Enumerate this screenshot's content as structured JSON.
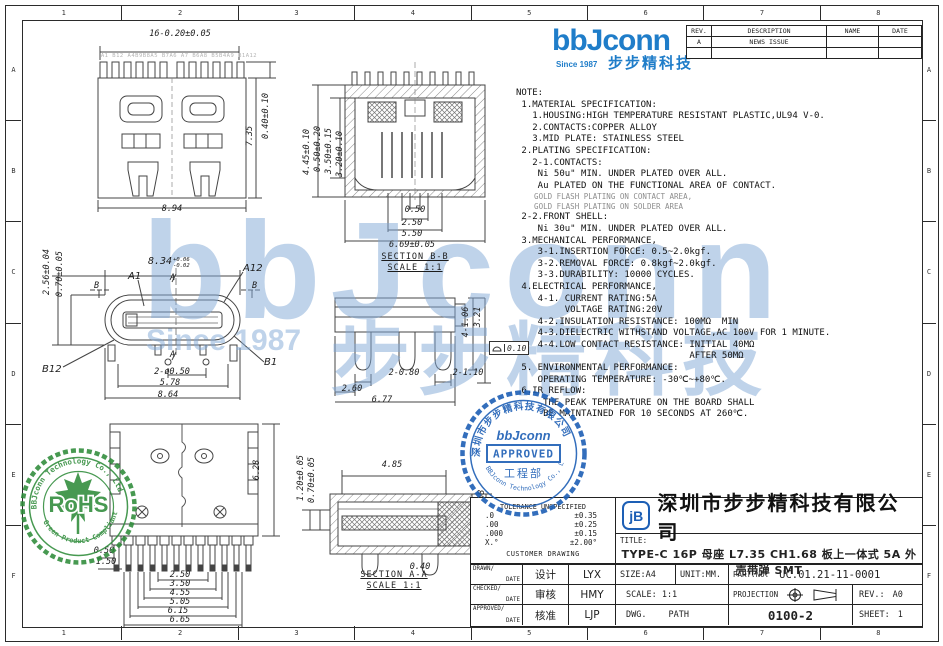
{
  "grid": {
    "cols": [
      "1",
      "2",
      "3",
      "4",
      "5",
      "6",
      "7",
      "8"
    ],
    "rows": [
      "A",
      "B",
      "C",
      "D",
      "E",
      "F"
    ]
  },
  "header": {
    "brand": "bbJconn",
    "since": "Since 1987",
    "brand_cn": "步步精科技"
  },
  "rev_table": {
    "h_rev": "REV.",
    "h_desc": "DESCRIPTION",
    "h_name": "NAME",
    "h_date": "DATE",
    "r1_rev": "A",
    "r1_desc": "NEWS ISSUE"
  },
  "note": {
    "part1": "NOTE:\n 1.MATERIAL SPECIFICATION:\n   1.HOUSING:HIGH TEMPERATURE RESISTANT PLASTIC,UL94 V-0.\n   2.CONTACTS:COPPER ALLOY\n   3.MID PLATE: STAINLESS STEEL\n 2.PLATING SPECIFICATION:\n   2-1.CONTACTS:\n    Ni 50u\" MIN. UNDER PLATED OVER ALL.\n    Au PLATED ON THE FUNCTIONAL AREA OF CONTACT.",
    "gold1": "    GOLD FLASH PLATING ON CONTACT AREA,",
    "gold2": "    GOLD FLASH PLATING ON SOLDER AREA",
    "part2": " 2-2.FRONT SHELL:\n    Ni 30u\" MIN. UNDER PLATED OVER ALL.\n 3.MECHANICAL PERFORMANCE,\n    3-1.INSERTION FORCE: 0.5~2.0kgf.\n    3-2.REMOVAL FORCE: 0.8kgf~2.0kgf.\n    3-3.DURABILITY: 10000 CYCLES.\n 4.ELECTRICAL PERFORMANCE,\n    4-1. CURRENT RATING:5A\n         VOLTAGE RATING:20V\n    4-2.INSULATION RESISTANCE: 100MΩ  MIN\n    4-3.DIELECTRIC WITHSTAND VOLTAGE,AC 100V FOR 1 MINUTE.\n    4-4.LOW CONTACT RESISTANCE: INITIAL 40MΩ\n                                AFTER 50MΩ\n 5. ENVIRONMENTAL PERFORMANCE:\n    OPERATING TEMPERATURE: -30℃~+80℃.\n 6.IR REFLOW:\n     THE PEAK TEMPERATURE ON THE BOARD SHALL\n     BE MAINTAINED FOR 10 SECONDS AT 260℃."
  },
  "drawings": {
    "front": {
      "dim_top": "16-0.20±0.05",
      "pins_label": "A1 B12 A4B9B8A5 B7A6 A7 B6A8 B5B4A9 B1A12",
      "dim_height": "7.35",
      "dim_pin_h": "0.40±0.10",
      "dim_width": "8.94"
    },
    "section_bb": {
      "label": "SECTION B-B",
      "scale": "SCALE 1:1",
      "left_dims": [
        "4.45±0.10",
        "0.50±0.20",
        "3.50±0.15",
        "3.20±0.10"
      ],
      "bottom_dims": [
        "0.50",
        "2.50",
        "5.50",
        "6.69±0.05"
      ]
    },
    "face": {
      "dim_top_value": "8.34",
      "dim_top_up": "+0.06",
      "dim_top_dn": "-0.02",
      "pin_a1": "A1",
      "pin_a12": "A12",
      "pin_b12": "B12",
      "pin_b1": "B1",
      "sec_a": "A",
      "sec_b": "B",
      "dim_left1": "2.56±0.04",
      "dim_left2": "0.70±0.05",
      "dim_holes": "2-ø0.50",
      "dim_span": "5.78",
      "dim_width": "8.64"
    },
    "side": {
      "dim_v1": "4-1.06",
      "dim_v2": "3.21",
      "dim_p1": "2-0.80",
      "dim_p2": "2-1.10",
      "dim_b1": "2.60",
      "dim_b2": "6.77",
      "flatness": "0.10"
    },
    "bottom": {
      "dim_height": "6.28",
      "stack": [
        "0.50",
        "1.50",
        "2.50",
        "3.50",
        "4.55",
        "5.05",
        "6.15",
        "6.65"
      ]
    },
    "section_aa": {
      "label": "SECTION A-A",
      "scale": "SCALE 1:1",
      "dim_left1": "1.20±0.05",
      "dim_left2": "0.70±0.05",
      "dim_top": "4.85",
      "dim_ch": "CH1.68",
      "dim_foot": "0.40"
    }
  },
  "stamps": {
    "rohs": {
      "arc_top": "BBJconn Technology Co., Ltd",
      "arc_bottom": "Green Product Compliant",
      "text": "RoHS"
    },
    "approved": {
      "arc_top": "深圳市步步精科技有限公司",
      "arc_bottom": "BBJconn Technology Co., Ltd",
      "logo": "bbJconn",
      "text": "APPROVED",
      "dept": "工程部"
    }
  },
  "watermark": {
    "brand": "bbJconn",
    "since": "Since 1987",
    "cn": "步步精科技"
  },
  "tb": {
    "tol_header": "TOLERANCE UNSPECIFIED",
    "tol_1a": ".0",
    "tol_1b": "±0.35",
    "tol_2a": ".00",
    "tol_2b": "±0.25",
    "tol_3a": ".000",
    "tol_3b": "±0.15",
    "tol_4a": "X.°",
    "tol_4b": "±2.00°",
    "tol_footer": "CUSTOMER DRAWING",
    "logo": "jB",
    "company": "深圳市步步精科技有限公司",
    "title_label": "TITLE:",
    "title": "TYPE-C 16P 母座 L7.35 CH1.68 板上一体式 5A 外壳带弹 SMT",
    "r1_role": "DRAWN/",
    "r1_date": "DATE",
    "r1_cn": "设计",
    "r1_name": "LYX",
    "r1_size": "SIZE:A4",
    "r1_unit": "UNIT:MM.",
    "r1_pn_label": "PART.NO:",
    "r1_pn": "UC.01.21-11-0001",
    "r2_role": "CHECKED/",
    "r2_date": "DATE",
    "r2_cn": "审核",
    "r2_name": "HMY",
    "r2_scale": "SCALE: 1:1",
    "r2_proj": "PROJECTION",
    "r2_rev_label": "REV.:",
    "r2_rev_val": "A0",
    "r3_role": "APPROVED/",
    "r3_date": "DATE",
    "r3_cn": "核准",
    "r3_name": "LJP",
    "r3_dwg": "DWG.",
    "r3_path": "PATH",
    "r3_num": "0100-2",
    "r3_sheet_label": "SHEET:",
    "r3_sheet_val": "1"
  }
}
